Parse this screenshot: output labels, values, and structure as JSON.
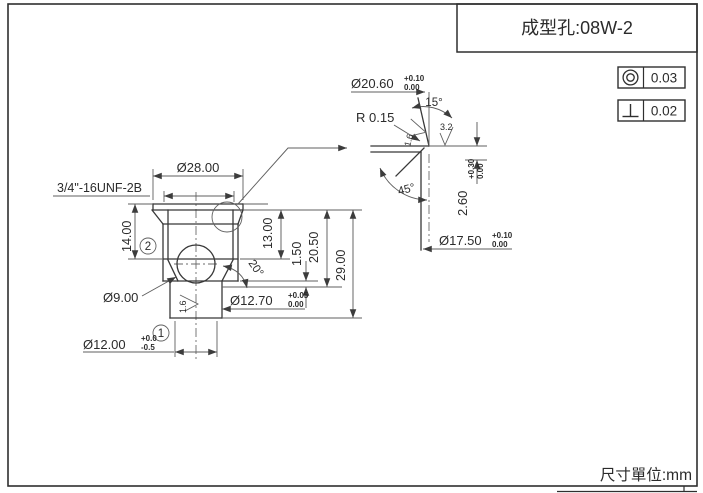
{
  "page": {
    "title": "成型孔:08W-2",
    "units": "尺寸單位:mm"
  },
  "frames": {
    "concentricity_value": "0.03",
    "perpendicularity_value": "0.02"
  },
  "main": {
    "thread_spec": "3/4\"-16UNF-2B",
    "flange_dia": "Ø28.00",
    "flange_height": "14.00",
    "bore_depth": "13.00",
    "step": "1.50",
    "shoulder": "20.50",
    "overall": "29.00",
    "ball_dia": "Ø9.00",
    "cone_angle": "20°",
    "stem_dia": "Ø12.70",
    "stem_tol_up": "+0.05",
    "stem_tol_dn": "0.00",
    "tip_dia": "Ø12.00",
    "tip_tol_up": "+0.0",
    "tip_tol_dn": "-0.5",
    "balloon1": "1",
    "balloon2": "2",
    "roughness": "1.6"
  },
  "detail": {
    "mouth_dia": "Ø20.60",
    "mouth_tol_up": "+0.10",
    "mouth_tol_dn": "0.00",
    "taper_angle": "15°",
    "radius": "R 0.15",
    "rough_taper": "1.6",
    "rough_seat": "3.2",
    "chamfer_angle": "45°",
    "depth": "2.60",
    "depth_tol_up": "+0.30",
    "depth_tol_dn": "0.00",
    "bore_dia": "Ø17.50",
    "bore_tol_up": "+0.10",
    "bore_tol_dn": "0.00"
  }
}
